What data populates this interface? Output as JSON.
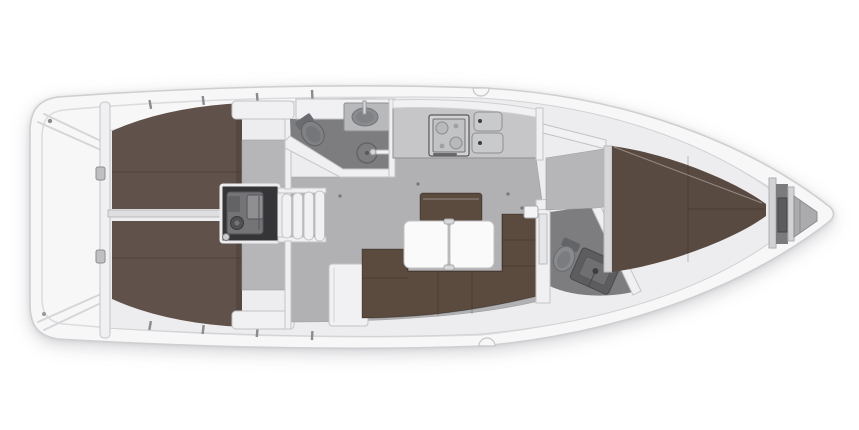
{
  "diagram": {
    "type": "yacht-interior-floor-plan",
    "orientation": "bow-right",
    "regions": [
      "transom-cockpit",
      "aft-cabin-starboard",
      "aft-cabin-port",
      "engine-compartment",
      "companionway-steps",
      "aft-heads",
      "galley",
      "saloon",
      "saloon-table",
      "wardrobe",
      "forward-heads",
      "forward-cabin-v-berth",
      "anchor-locker",
      "bow"
    ],
    "fixtures": [
      "toilet",
      "washbasin",
      "shower-drain",
      "shower-tray",
      "stove",
      "double-sink",
      "settee",
      "table-leaves",
      "berth-cushions"
    ]
  },
  "colors": {
    "background": "#ffffff",
    "hull": "#f7f7f8",
    "hull_stroke": "#cfcfd2",
    "deck_line": "#dcdcdf",
    "deck": "#ededef",
    "deck_stroke": "#d2d2d5",
    "wall": "#f0f0f2",
    "floor": "#b1b1b3",
    "cabin_floor": "#b6b6b8",
    "heads_floor": "#7d7d80",
    "berth": "#60514a",
    "berth_dark": "#4c4139",
    "berth_fwd": "#594a41",
    "settee": "#5b4a3e",
    "furniture": "#f1f1f3",
    "counter": "#c6c6c8",
    "table": "#fafafb",
    "engine": "#353537",
    "engine_rim": "#ececee",
    "engine_block": "#747477",
    "fixture": "#8a8b8e",
    "fixture_dark": "#5f6063",
    "metal": "#c0c0c3",
    "divider": "#dedee0",
    "locker_gap": "#7b7b7e",
    "bow_chamber": "#ababad",
    "hose": "#b9a98e"
  }
}
